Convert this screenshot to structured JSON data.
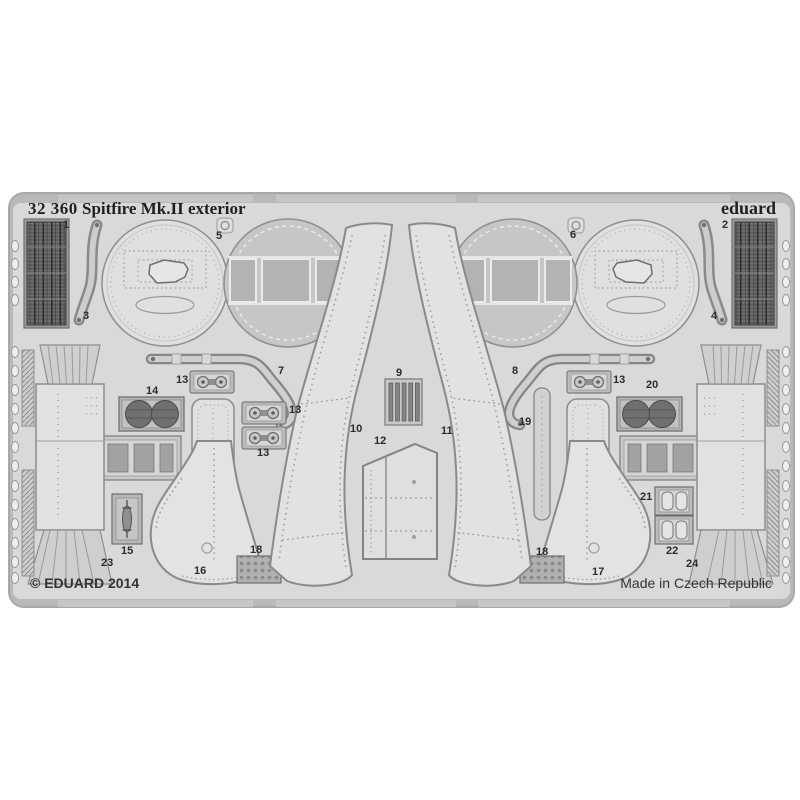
{
  "product": {
    "catalog_number": "32 360",
    "title": "Spitfire Mk.II exterior",
    "brand": "eduard",
    "copyright": "© EDUARD 2014",
    "made_in": "Made in Czech Republic"
  },
  "colors": {
    "background": "#ffffff",
    "sheet": "#d9d9d9",
    "frame": "#a6a6a6",
    "part_fill": "#e2e2e2",
    "part_stroke": "#8a8a8a",
    "dark_part": "#5d5d5d",
    "text": "#1f1f1f",
    "footer_text": "#333333"
  },
  "part_labels": [
    {
      "label": "1"
    },
    {
      "label": "2"
    },
    {
      "label": "3"
    },
    {
      "label": "4"
    },
    {
      "label": "5"
    },
    {
      "label": "6"
    },
    {
      "label": "7"
    },
    {
      "label": "8"
    },
    {
      "label": "9"
    },
    {
      "label": "10"
    },
    {
      "label": "11"
    },
    {
      "label": "12"
    },
    {
      "label": "13"
    },
    {
      "label": "13"
    },
    {
      "label": "13"
    },
    {
      "label": "13"
    },
    {
      "label": "14"
    },
    {
      "label": "15"
    },
    {
      "label": "16"
    },
    {
      "label": "17"
    },
    {
      "label": "18"
    },
    {
      "label": "18"
    },
    {
      "label": "19"
    },
    {
      "label": "20"
    },
    {
      "label": "21"
    },
    {
      "label": "22"
    },
    {
      "label": "23"
    },
    {
      "label": "24"
    }
  ]
}
